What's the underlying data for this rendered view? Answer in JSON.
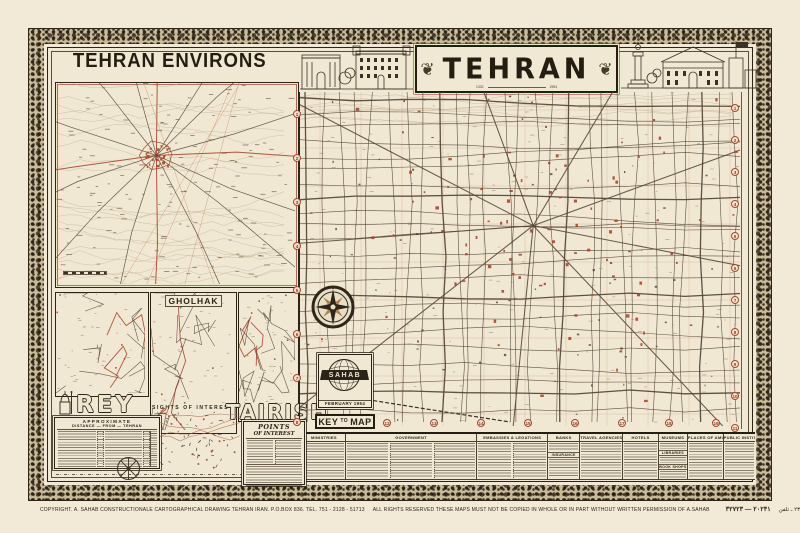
{
  "colors": {
    "paper": "#f1e8d3",
    "ink": "#2c2418",
    "accent_red": "#a8462c",
    "street": "#5a4c3b"
  },
  "left_panel": {
    "title": "TEHRAN ENVIRONS",
    "insets": {
      "gholhak_label": "GHOLHAK",
      "rey_label": "REY",
      "tajrish_label": "TAJRISH",
      "sights_caption": "SIGHTS OF INTEREST"
    },
    "distance_table": {
      "line1": "APPROXIMATE",
      "line2": "DISTANCE — FROM — TEHRAN"
    },
    "points_of_interest": {
      "line1": "POINTS",
      "line2": "OF INTEREST"
    }
  },
  "banner": {
    "title": "TEHRAN",
    "year_left": "1332",
    "year_right": "1954"
  },
  "key_panel": {
    "logo_text": "SAHAB",
    "date_text": "FEBRUARY 1954",
    "key_word": "KEY",
    "to_word": "TO",
    "map_word": "MAP"
  },
  "legend": {
    "columns": [
      {
        "header": "MINISTRIES"
      },
      {
        "header": "GOVERNMENT"
      },
      {
        "header": "EMBASSIES & LEGATIONS"
      },
      {
        "header": "BANKS",
        "subheader": "INSURANCE"
      },
      {
        "header": "TRAVEL AGENCIES"
      },
      {
        "header": "HOTELS"
      },
      {
        "header": "MUSEUMS",
        "subheaders": [
          "LIBRARIES",
          "BOOK SHOPS"
        ]
      },
      {
        "header": "PLACES OF AMUSEMENT"
      },
      {
        "header": "PUBLIC INSTITUTIONS"
      }
    ]
  },
  "edge_numbers": {
    "right": [
      "1",
      "2",
      "3",
      "4",
      "5",
      "6",
      "7",
      "8",
      "9",
      "10",
      "11"
    ],
    "left": [
      "1",
      "2",
      "3",
      "4",
      "5",
      "6",
      "7",
      "8"
    ],
    "bottom": [
      "12",
      "13",
      "14",
      "15",
      "16",
      "17",
      "18",
      "19"
    ]
  },
  "footer": {
    "copyright": "COPYRIGHT. A. SAHAB CONSTRUCTIONALE CARTOGRAPHICAL DRAWING TEHRAN IRAN. P.O.BOX 836. TEL. 751 - 2128 - 51713",
    "rights": "ALL RIGHTS RESERVED THESE MAPS MUST NOT BE COPIED IN WHOLE OR IN PART WITHOUT WRITTEN PERMISSION OF A.SAHAB",
    "serial": "۳۲۷۲۳ — ۲۰۲۴۱",
    "persian_address": "نشانی: تهران ـ صندوق پستی ۲۳۵ ـ تلفن"
  }
}
